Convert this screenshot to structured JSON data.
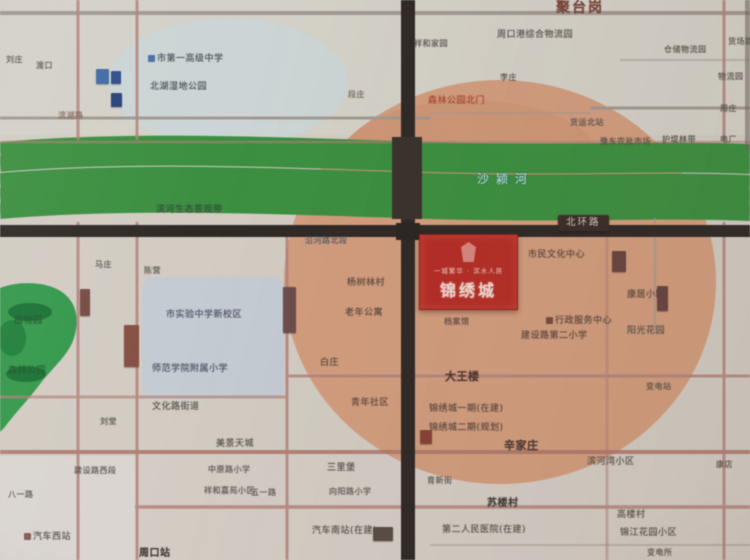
{
  "colors": {
    "accent_red": "#bb2a22",
    "circle_salmon": "#d79a78",
    "river_blue": "#2e6cb0",
    "river_bank_green": "#37913c",
    "park_green": "#2f9b49",
    "road_black": "#2e2724",
    "road_pink": "#b5827a",
    "map_base": "#d5cec5"
  },
  "project": {
    "name": "锦绣城",
    "tagline": "一城繁华 · 滨水人居"
  },
  "river": {
    "name": "沙颍河"
  },
  "road_capsule": {
    "text": "北环路"
  },
  "labels": [
    {
      "t": "刘庄",
      "x": 6,
      "y": 56,
      "s": 8
    },
    {
      "t": "渡口",
      "x": 36,
      "y": 62,
      "s": 8
    },
    {
      "t": "市第一高级中学",
      "x": 148,
      "y": 55,
      "s": 9,
      "c": "#3f4a58",
      "i": "#4a6fa5"
    },
    {
      "t": "北湖湿地公园",
      "x": 150,
      "y": 83,
      "s": 9,
      "c": "#3f4a58"
    },
    {
      "t": "滨湖路",
      "x": 58,
      "y": 112,
      "s": 8,
      "c": "#8a6a5c"
    },
    {
      "t": "段庄",
      "x": 348,
      "y": 91,
      "s": 8,
      "c": "#6a665e"
    },
    {
      "t": "滨河生态景观带",
      "x": 156,
      "y": 206,
      "s": 9,
      "c": "#2a4a33"
    },
    {
      "t": "护堤林带",
      "x": 662,
      "y": 136,
      "s": 8,
      "c": "#4a4a42"
    },
    {
      "t": "聚台岗",
      "x": 556,
      "y": 1,
      "s": 14,
      "c": "#7c4034",
      "b": 1,
      "ls": 2
    },
    {
      "t": "周口港综合物流园",
      "x": 497,
      "y": 31,
      "s": 9,
      "c": "#55504a"
    },
    {
      "t": "祥和家园",
      "x": 414,
      "y": 40,
      "s": 8,
      "c": "#55504a"
    },
    {
      "t": "李庄",
      "x": 500,
      "y": 74,
      "s": 8,
      "c": "#55504a"
    },
    {
      "t": "森林公园北门",
      "x": 428,
      "y": 97,
      "s": 9,
      "c": "#c23b2d"
    },
    {
      "t": "货运北站",
      "x": 570,
      "y": 119,
      "s": 8,
      "c": "#55504a"
    },
    {
      "t": "豫东农批市场",
      "x": 600,
      "y": 138,
      "s": 8,
      "c": "#55504a"
    },
    {
      "t": "仓储物流园",
      "x": 664,
      "y": 46,
      "s": 8,
      "c": "#55504a"
    },
    {
      "t": "货场路",
      "x": 728,
      "y": 38,
      "s": 8
    },
    {
      "t": "物流园",
      "x": 718,
      "y": 73,
      "s": 8
    },
    {
      "t": "周庄",
      "x": 720,
      "y": 105,
      "s": 8
    },
    {
      "t": "电厂",
      "x": 720,
      "y": 136,
      "s": 8
    },
    {
      "t": "市民文化中心",
      "x": 528,
      "y": 251,
      "s": 9,
      "c": "#5c4438"
    },
    {
      "t": "档案馆",
      "x": 444,
      "y": 318,
      "s": 8,
      "c": "#5c4438"
    },
    {
      "t": "行政服务中心",
      "x": 546,
      "y": 317,
      "s": 9,
      "c": "#5c4438",
      "i": "#7a4a3a"
    },
    {
      "t": "建设路第二小学",
      "x": 521,
      "y": 332,
      "s": 9,
      "c": "#5c4438"
    },
    {
      "t": "康居小区",
      "x": 627,
      "y": 291,
      "s": 9,
      "c": "#5c4438"
    },
    {
      "t": "阳光花园",
      "x": 627,
      "y": 327,
      "s": 9,
      "c": "#55504a"
    },
    {
      "t": "大王楼",
      "x": 445,
      "y": 371,
      "s": 11,
      "c": "#4f352c",
      "b": 1
    },
    {
      "t": "锦绣城一期(在建)",
      "x": 429,
      "y": 405,
      "s": 9,
      "c": "#5c4438"
    },
    {
      "t": "锦绣城二期(规划)",
      "x": 429,
      "y": 424,
      "s": 9,
      "c": "#5c4438"
    },
    {
      "t": "辛家庄",
      "x": 504,
      "y": 440,
      "s": 11,
      "c": "#4f352c",
      "b": 1
    },
    {
      "t": "滨河湾小区",
      "x": 587,
      "y": 458,
      "s": 9,
      "c": "#55504a"
    },
    {
      "t": "变电站",
      "x": 646,
      "y": 383,
      "s": 8,
      "c": "#55504a"
    },
    {
      "t": "沿河路北段",
      "x": 305,
      "y": 237,
      "s": 8,
      "c": "#4a5568"
    },
    {
      "t": "杨树林村",
      "x": 347,
      "y": 279,
      "s": 9,
      "c": "#5c4438"
    },
    {
      "t": "老年公寓",
      "x": 345,
      "y": 309,
      "s": 9,
      "c": "#5c4438"
    },
    {
      "t": "白庄",
      "x": 320,
      "y": 359,
      "s": 9,
      "c": "#5c4438"
    },
    {
      "t": "青年社区",
      "x": 351,
      "y": 399,
      "s": 9,
      "c": "#5c4438"
    },
    {
      "t": "植物园",
      "x": 14,
      "y": 317,
      "s": 9,
      "c": "#0d5f24"
    },
    {
      "t": "森林公园",
      "x": 8,
      "y": 367,
      "s": 9,
      "c": "#0d5f24"
    },
    {
      "t": "马庄",
      "x": 95,
      "y": 261,
      "s": 8
    },
    {
      "t": "陈营",
      "x": 144,
      "y": 267,
      "s": 8
    },
    {
      "t": "市实验中学新校区",
      "x": 166,
      "y": 311,
      "s": 9,
      "c": "#46506b"
    },
    {
      "t": "师范学院附属小学",
      "x": 152,
      "y": 365,
      "s": 9,
      "c": "#46506b"
    },
    {
      "t": "文化路街道",
      "x": 152,
      "y": 403,
      "s": 9,
      "c": "#55504a"
    },
    {
      "t": "刘堂",
      "x": 100,
      "y": 418,
      "s": 8
    },
    {
      "t": "美景天城",
      "x": 216,
      "y": 440,
      "s": 9
    },
    {
      "t": "建设路西段",
      "x": 74,
      "y": 467,
      "s": 8
    },
    {
      "t": "八一路",
      "x": 8,
      "y": 491,
      "s": 8
    },
    {
      "t": "汽车西站",
      "x": 24,
      "y": 533,
      "s": 9,
      "i": "#8a5a50"
    },
    {
      "t": "周口站",
      "x": 139,
      "y": 549,
      "s": 10,
      "b": 1,
      "c": "#413a36"
    },
    {
      "t": "中原路小学",
      "x": 208,
      "y": 466,
      "s": 8
    },
    {
      "t": "祥和嘉苑小区",
      "x": 204,
      "y": 487,
      "s": 8
    },
    {
      "t": "三里堡",
      "x": 327,
      "y": 464,
      "s": 9,
      "c": "#4f4a44"
    },
    {
      "t": "五一路",
      "x": 251,
      "y": 489,
      "s": 8
    },
    {
      "t": "向阳路小学",
      "x": 329,
      "y": 488,
      "s": 8
    },
    {
      "t": "汽车南站(在建)",
      "x": 312,
      "y": 527,
      "s": 9
    },
    {
      "t": "育新街",
      "x": 427,
      "y": 477,
      "s": 8,
      "c": "#55504a"
    },
    {
      "t": "苏楼村",
      "x": 487,
      "y": 499,
      "s": 10,
      "b": 1,
      "c": "#413a36"
    },
    {
      "t": "第二人民医院(在建)",
      "x": 442,
      "y": 526,
      "s": 9
    },
    {
      "t": "高楼村",
      "x": 617,
      "y": 511,
      "s": 9
    },
    {
      "t": "锦江花园小区",
      "x": 620,
      "y": 529,
      "s": 9
    },
    {
      "t": "变电所",
      "x": 647,
      "y": 549,
      "s": 8
    },
    {
      "t": "康店",
      "x": 716,
      "y": 461,
      "s": 8
    }
  ],
  "markers": [
    {
      "n": "building-marker",
      "x": 80,
      "y": 289,
      "w": 10,
      "h": 27,
      "c": "#7a4a42"
    },
    {
      "n": "building-marker",
      "x": 124,
      "y": 325,
      "w": 15,
      "h": 42,
      "c": "#8a4e42"
    },
    {
      "n": "building-marker",
      "x": 283,
      "y": 287,
      "w": 13,
      "h": 46,
      "c": "#6e4c4a"
    },
    {
      "n": "building-marker",
      "x": 612,
      "y": 251,
      "w": 14,
      "h": 21,
      "c": "#6a433e"
    },
    {
      "n": "building-marker",
      "x": 657,
      "y": 286,
      "w": 11,
      "h": 25,
      "c": "#6a433e"
    },
    {
      "n": "building-marker",
      "x": 420,
      "y": 430,
      "w": 12,
      "h": 14,
      "c": "#8a4034"
    },
    {
      "n": "building-marker",
      "x": 373,
      "y": 527,
      "w": 20,
      "h": 14,
      "c": "#5a4a44"
    },
    {
      "n": "poi-marker",
      "x": 96,
      "y": 69,
      "w": 13,
      "h": 15,
      "c": "#3f6cab"
    },
    {
      "n": "poi-marker",
      "x": 111,
      "y": 71,
      "w": 10,
      "h": 13,
      "c": "#2c4f92"
    },
    {
      "n": "poi-marker",
      "x": 111,
      "y": 93,
      "w": 11,
      "h": 14,
      "c": "#27417e"
    }
  ]
}
